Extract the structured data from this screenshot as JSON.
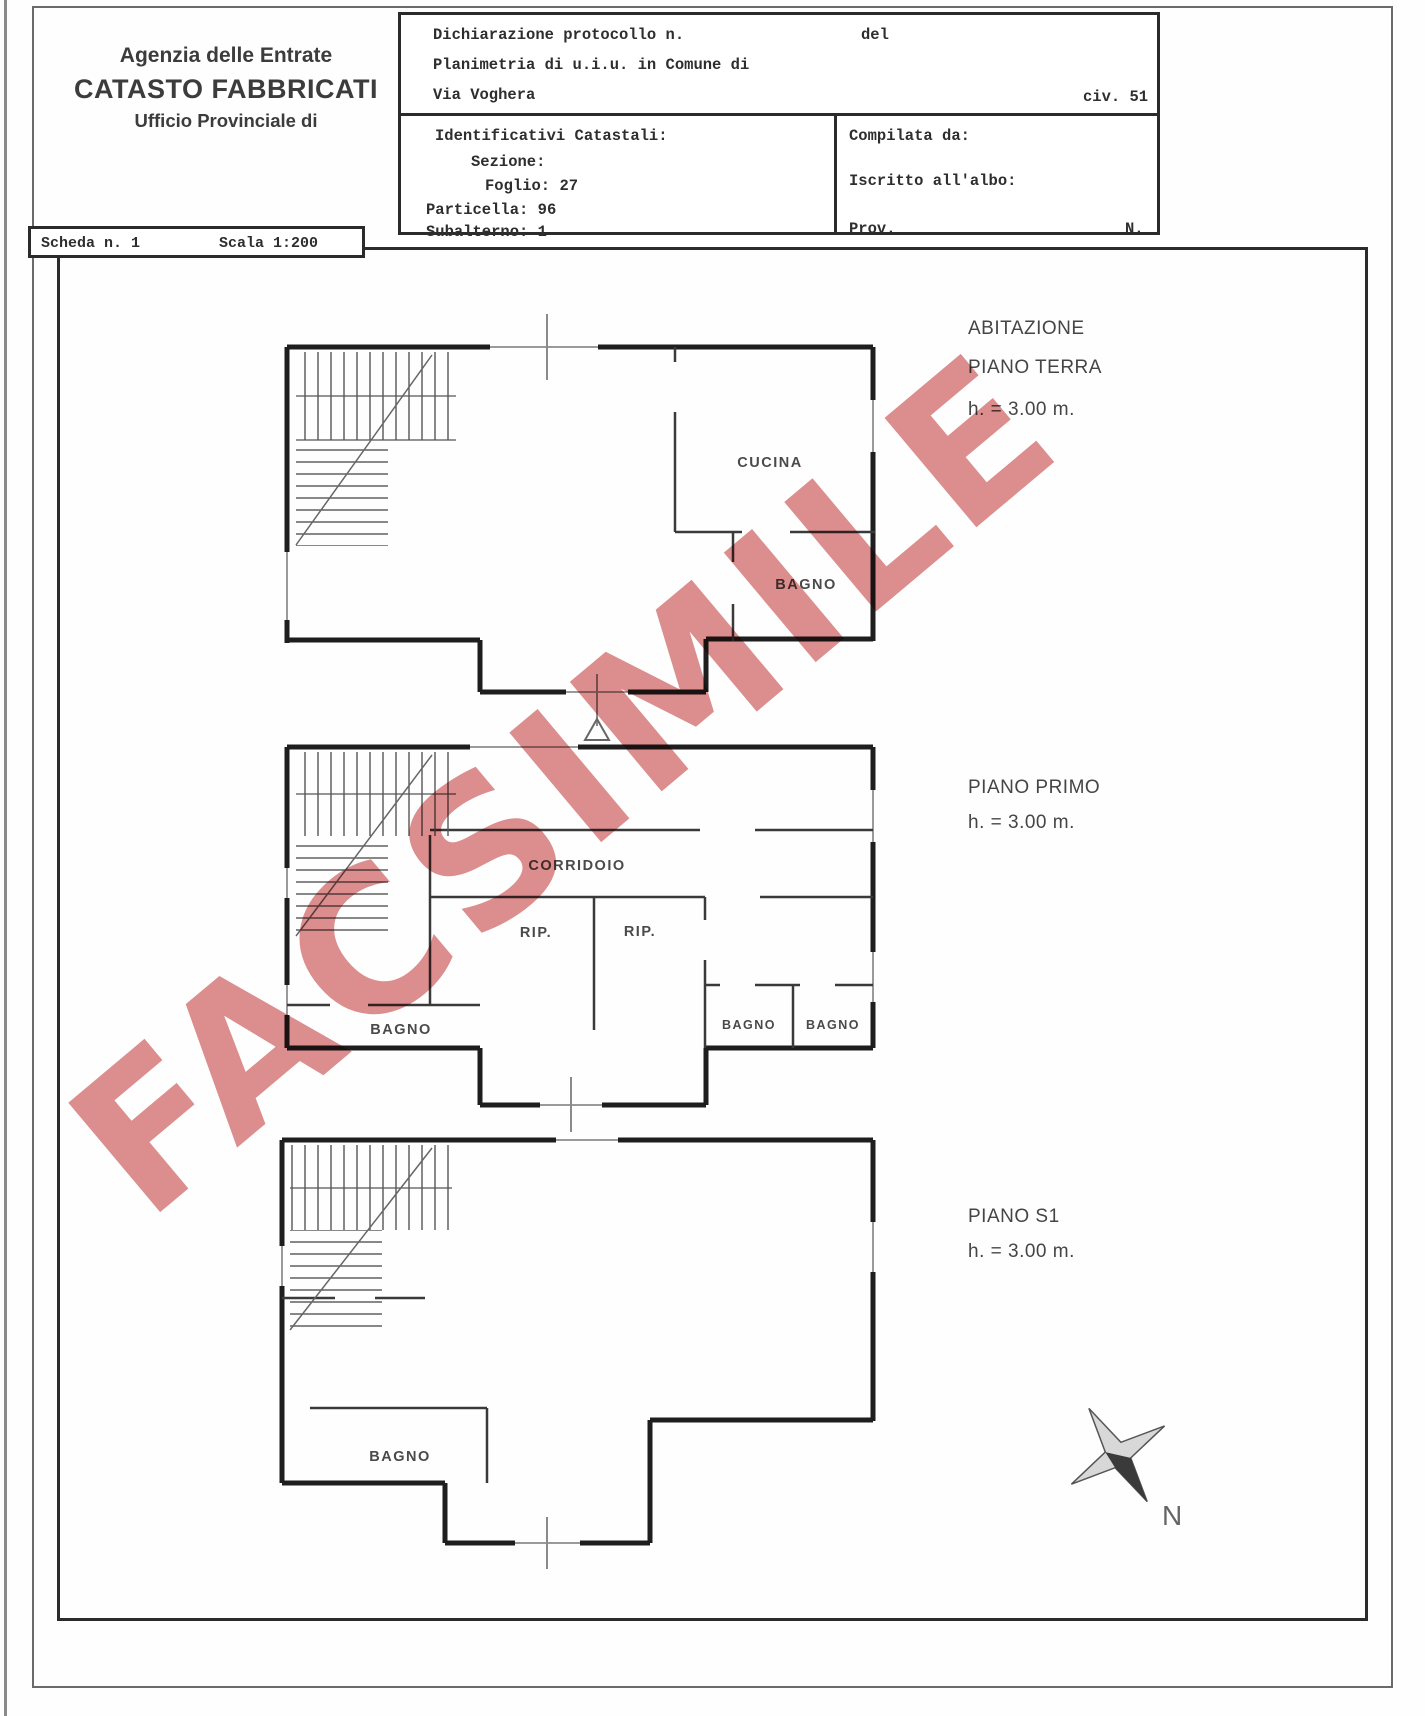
{
  "document": {
    "agency": {
      "line1": "Agenzia delle Entrate",
      "line2": "CATASTO FABBRICATI",
      "line3": "Ufficio Provinciale di"
    },
    "declaration": {
      "protocol_label": "Dichiarazione protocollo n.",
      "protocol_del": "del",
      "line2": "Planimetria di u.i.u. in Comune di",
      "street": "Via Voghera",
      "civic": "civ. 51"
    },
    "cadastral": {
      "title": "Identificativi Catastali:",
      "sezione_label": "Sezione:",
      "foglio_label": "Foglio:",
      "foglio_value": "27",
      "particella_label": "Particella:",
      "particella_value": "96",
      "subalterno_label": "Subalterno:",
      "subalterno_value": "1"
    },
    "compiler": {
      "compilata": "Compilata da:",
      "iscritto": "Iscritto all'albo:",
      "prov": "Prov.",
      "n": "N."
    },
    "sheet": {
      "scheda": "Scheda n. 1",
      "scala": "Scala 1:200"
    },
    "watermark": {
      "text": "FACSIMILE",
      "color": "#d97e7e"
    }
  },
  "floors": {
    "terra": {
      "line1": "ABITAZIONE",
      "line2": "PIANO TERRA",
      "height": "h. = 3.00 m.",
      "rooms": {
        "cucina": "CUCINA",
        "bagno": "BAGNO"
      }
    },
    "primo": {
      "line2": "PIANO PRIMO",
      "height": "h. = 3.00 m.",
      "rooms": {
        "corridoio": "CORRIDOIO",
        "rip1": "RIP.",
        "rip2": "RIP.",
        "bagno_left": "BAGNO",
        "bagno_mid": "BAGNO",
        "bagno_right": "BAGNO"
      }
    },
    "s1": {
      "line2": "PIANO S1",
      "height": "h. = 3.00 m.",
      "rooms": {
        "bagno": "BAGNO"
      }
    }
  },
  "compass": {
    "north": "N"
  }
}
